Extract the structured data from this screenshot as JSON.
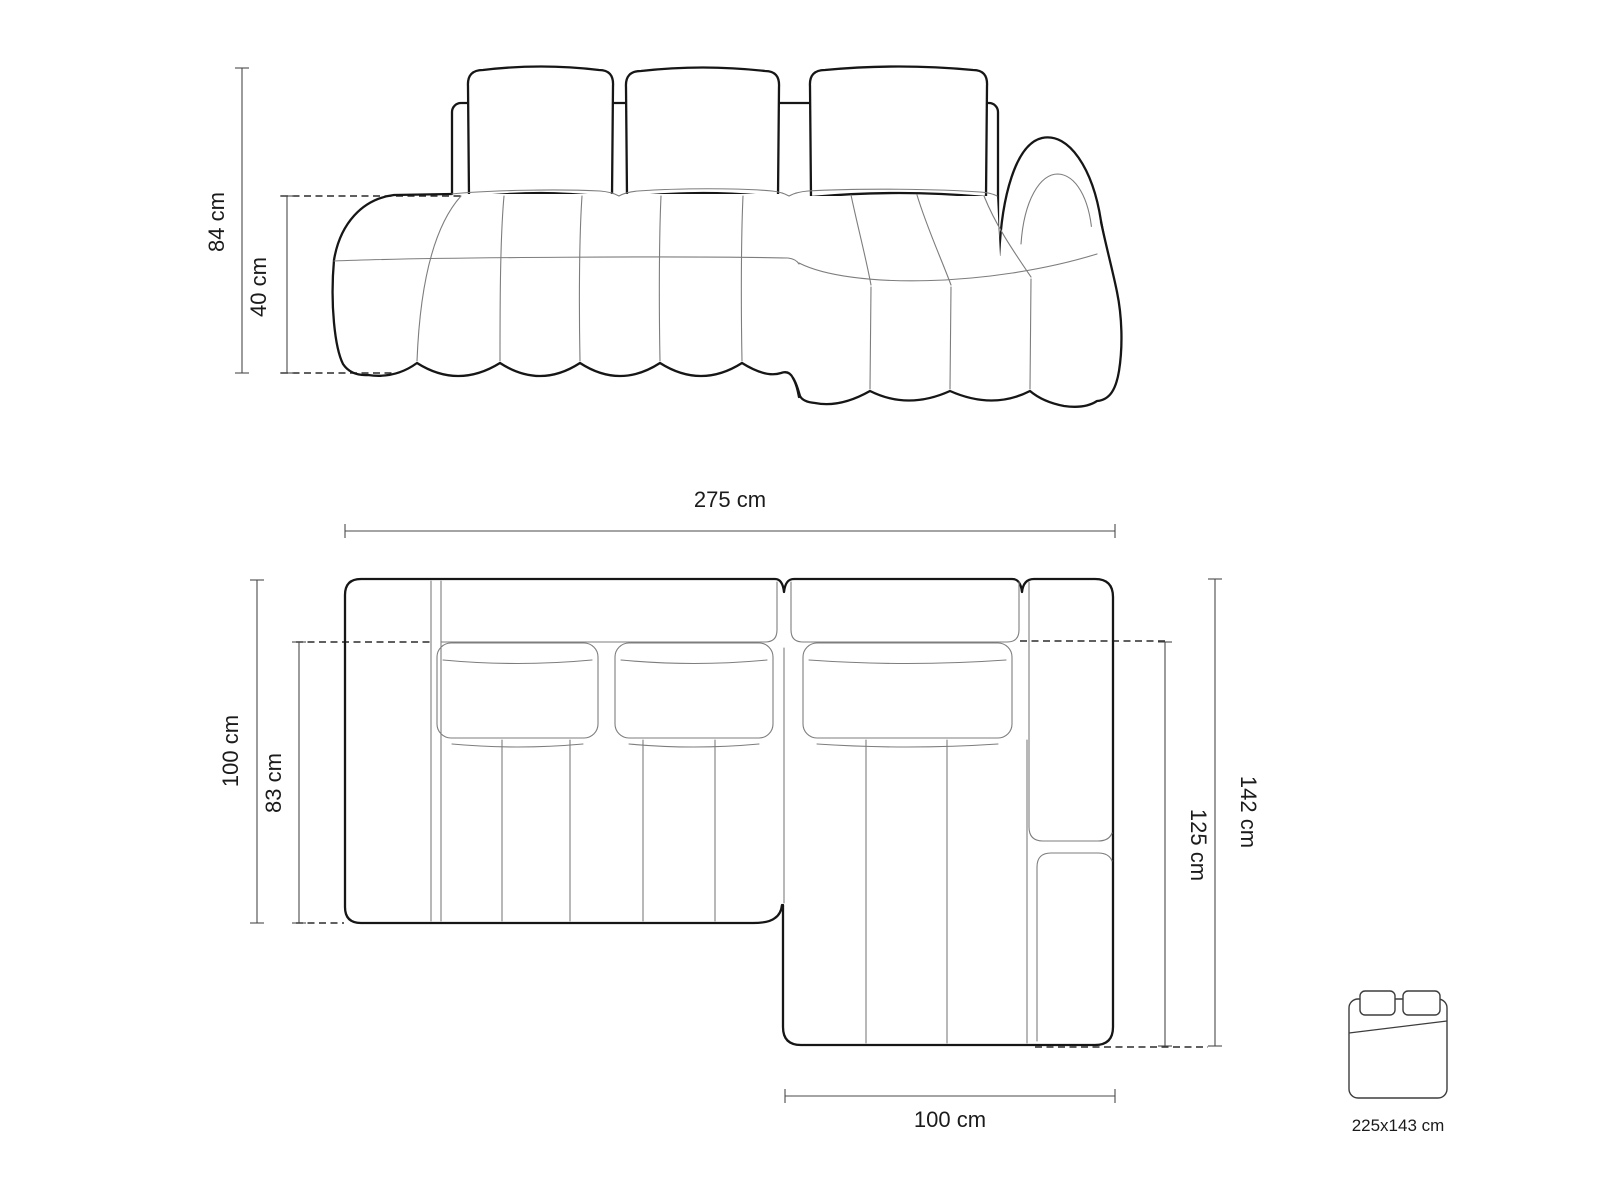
{
  "front_view": {
    "dim_total_height": "84 cm",
    "dim_seat_height": "40 cm"
  },
  "plan_view": {
    "dim_total_width": "275 cm",
    "dim_left_depth": "100 cm",
    "dim_seat_depth": "83 cm",
    "dim_right_depth": "142 cm",
    "dim_chaise_depth": "125 cm",
    "dim_chaise_width": "100 cm"
  },
  "sleeping_area": {
    "icon": "bed-icon",
    "size_label": "225x143 cm"
  },
  "colors": {
    "background": "#ffffff",
    "outline_bold": "#161616",
    "line_thin": "#7d7d7d",
    "line_dashed": "#2b2b2b",
    "dimension_line": "#4a4a4a",
    "text": "#1b1b1b"
  }
}
